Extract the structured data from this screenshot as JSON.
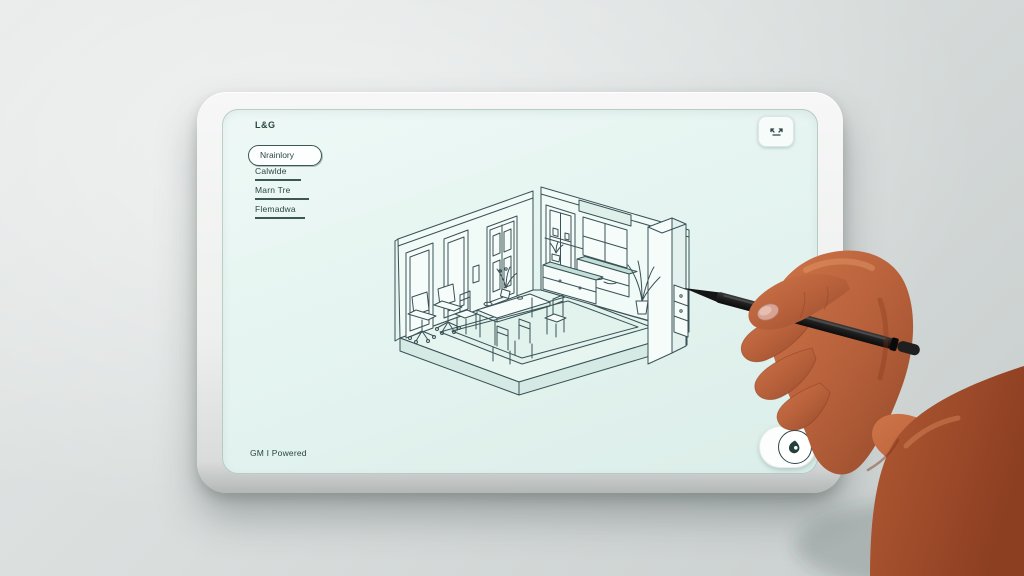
{
  "device": {
    "type": "tablet",
    "frame_color": "#f1f2f1",
    "screen_color": "#e3f3ef"
  },
  "screen": {
    "brand": "L&G",
    "sidebar": {
      "items": [
        {
          "label": "Nrainlory",
          "active": true
        },
        {
          "label": "Calwlde",
          "active": false
        },
        {
          "label": "Marn Tre",
          "active": false
        },
        {
          "label": "Flemadwa",
          "active": false
        }
      ]
    },
    "topbar": {
      "expand_icon": "expand-arrows"
    },
    "canvas": {
      "subject": "isometric room interior line sketch"
    },
    "footer": {
      "caption": "GM I Powered"
    },
    "fab": {
      "icon": "ink-drop"
    }
  },
  "colors": {
    "line_art": "#3a5256",
    "text": "#2c4643",
    "shade_accent": "#c3e0d8",
    "skin": "#b55f3a",
    "stylus": "#1c1c1c"
  }
}
